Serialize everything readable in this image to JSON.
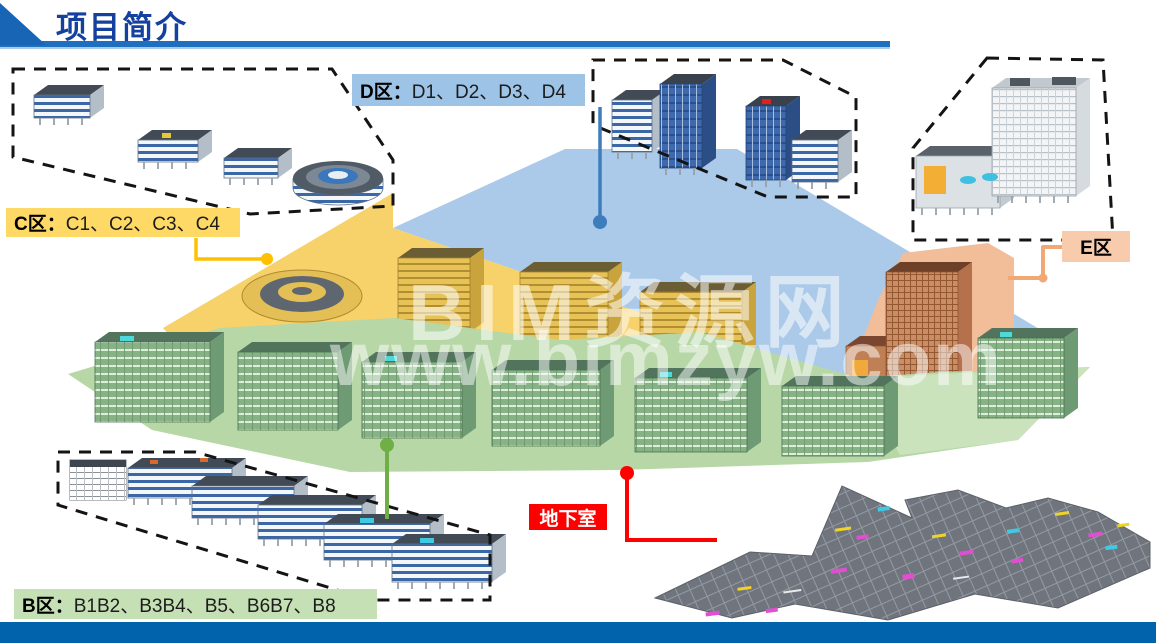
{
  "header": {
    "title": "项目简介"
  },
  "watermark": {
    "line1": "BIM资源网",
    "line2": "www.bimzyw.com"
  },
  "zones": {
    "c": {
      "label_prefix": "C区：",
      "label_items": "C1、C2、C3、C4",
      "label_bg": "#FFD966",
      "overlay_color": "#F7D169",
      "connector_color": "#FFC000"
    },
    "d": {
      "label_prefix": "D区：",
      "label_items": "D1、D2、D3、D4",
      "label_bg": "#9DC3E6",
      "overlay_color": "#ABC9E9",
      "connector_color": "#3E7DBC"
    },
    "e": {
      "label_text": "E区",
      "label_bg": "#F8CBAD",
      "overlay_color": "#F2BD99",
      "connector_color": "#F2A875"
    },
    "b": {
      "label_prefix": "B区：",
      "label_items": "B1B2、B3B4、B5、B6B7、B8",
      "label_bg": "#C5E0B4",
      "overlay_color": "#B7D7A6",
      "connector_color": "#6FAF46"
    },
    "basement": {
      "label_text": "地下室",
      "label_bg": "#FF0000",
      "label_color": "#FFFFFF",
      "connector_color": "#FF0000"
    }
  },
  "theme": {
    "title_color": "#14409E",
    "header_rule_color": "#1E6FC0",
    "footer_bar_color": "#0063AC"
  }
}
